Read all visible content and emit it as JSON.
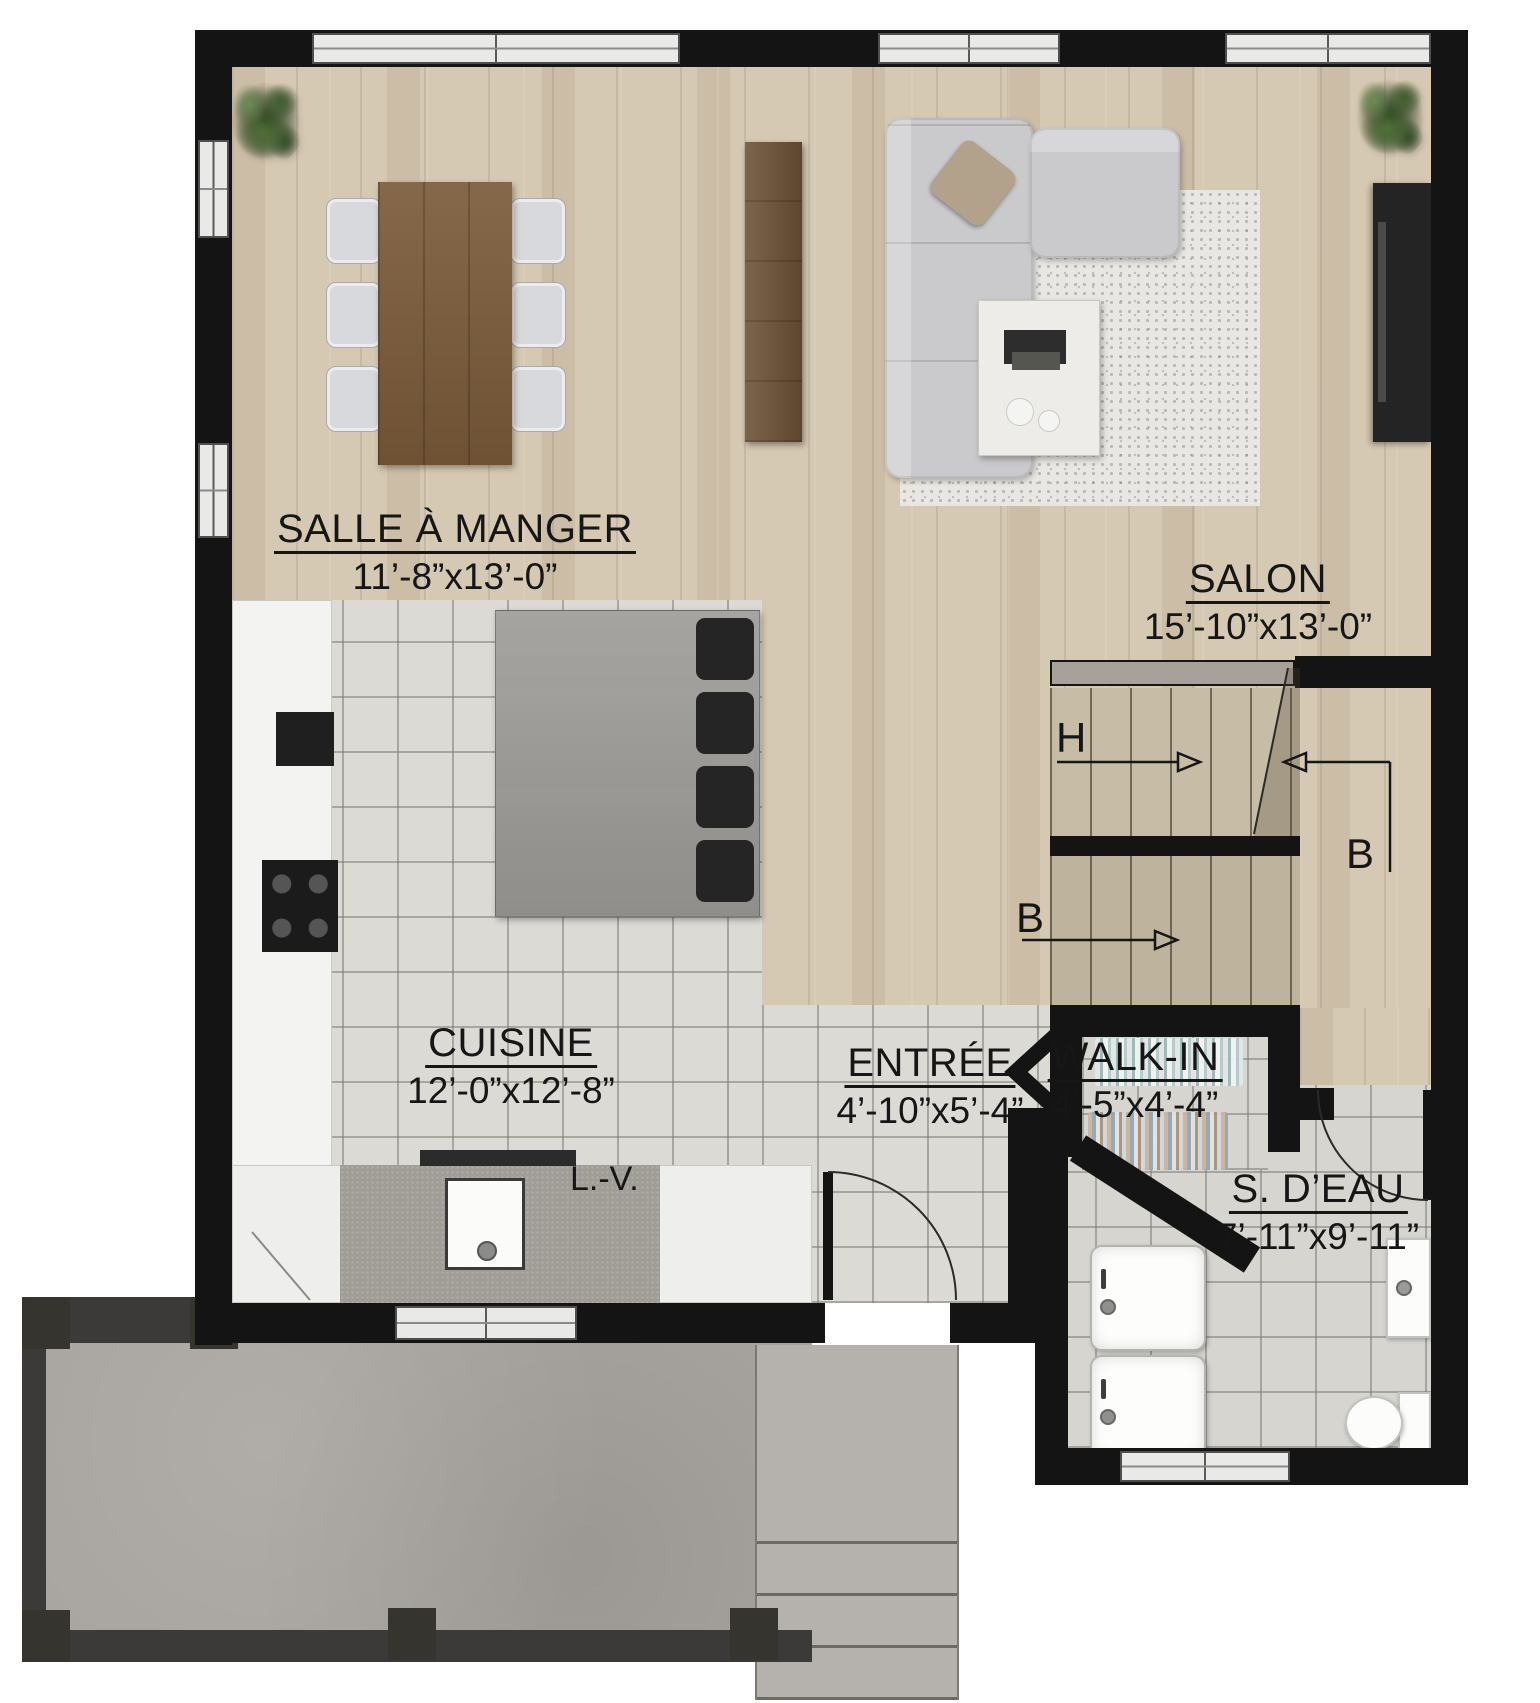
{
  "rooms": [
    {
      "id": "salle-a-manger",
      "name": "SALLE À MANGER",
      "dims": "11’-8”x13’-0”"
    },
    {
      "id": "salon",
      "name": "SALON",
      "dims": "15’-10”x13’-0”"
    },
    {
      "id": "cuisine",
      "name": "CUISINE",
      "dims": "12’-0”x12’-8”"
    },
    {
      "id": "entree",
      "name": "ENTRÉE",
      "dims": "4’-10”x5’-4”"
    },
    {
      "id": "walk-in",
      "name": "WALK-IN",
      "dims": "4’-5”x4’-4”"
    },
    {
      "id": "s-deau",
      "name": "S. D’EAU",
      "dims": "7’-11”x9’-11”"
    }
  ],
  "annotations": {
    "dishwasher": "L.-V.",
    "stair_up": "H",
    "stair_down": "B",
    "stair_down_return": "B"
  },
  "colors": {
    "wall": "#141414",
    "wood_floor": "#d6c9b3",
    "tile_floor": "#dcdad5",
    "deck": "#a7a39e",
    "stair_upper": "#c7bca6",
    "stair_lower": "#beb39d"
  }
}
